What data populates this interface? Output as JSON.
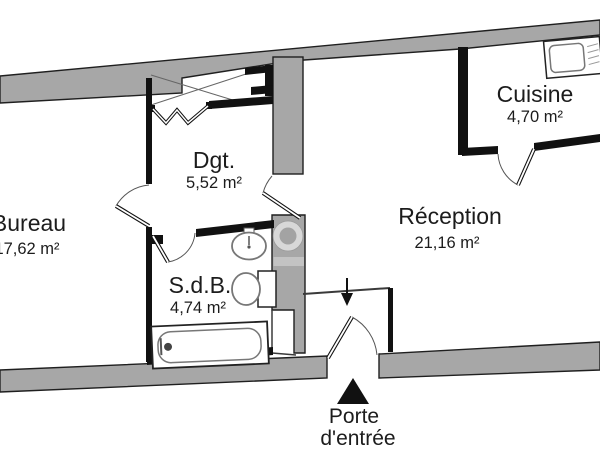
{
  "plan": {
    "rooms": [
      {
        "name": "Bureau",
        "area": "17,62 m²"
      },
      {
        "name": "Dgt.",
        "area": "5,52 m²"
      },
      {
        "name": "S.d.B.",
        "area": "4,74 m²"
      },
      {
        "name": "Cuisine",
        "area": "4,70 m²"
      },
      {
        "name": "Réception",
        "area": "21,16 m²"
      }
    ],
    "entrance_label": {
      "line1": "Porte",
      "line2": "d'entrée"
    },
    "colors": {
      "exterior_wall": "#a7a7a7",
      "interior_wall": "#111111",
      "fixture_outline": "#777777",
      "door_line": "#555555",
      "background": "#ffffff"
    }
  }
}
